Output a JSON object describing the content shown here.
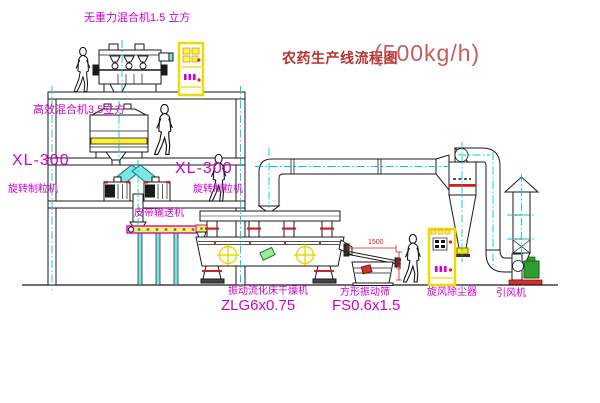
{
  "title": {
    "name": "农药生产线流程图",
    "capacity": "(500kg/h)"
  },
  "equipment_labels": {
    "gravity_mixer": "无重力混合机1.5 立方",
    "high_eff_mixer": "高效混合机3.5立方",
    "granulator_left_model": "XL-300",
    "granulator_left_name": "旋转制粒机",
    "granulator_right_model": "XL-300",
    "granulator_right_name": "旋转制粒机",
    "belt_conveyor": "皮带输送机",
    "dryer_name": "振动流化床干燥机",
    "dryer_model": "ZLG6x0.75",
    "sieve_name": "方形振动筛",
    "sieve_model": "FS0.6x1.5",
    "cyclone": "旋风除尘器",
    "fan": "引风机"
  },
  "dimensions": {
    "sieve_length": "1500",
    "sieve_height": "500"
  },
  "colors": {
    "label_magenta": "#cc00cc",
    "title_red": "#b43232",
    "line_black": "#1a1a1a",
    "highlight_yellow": "#ffe800",
    "centerline_cyan": "#00cccc",
    "accent_red": "#cc2222",
    "accent_green": "#2f9e2f"
  }
}
